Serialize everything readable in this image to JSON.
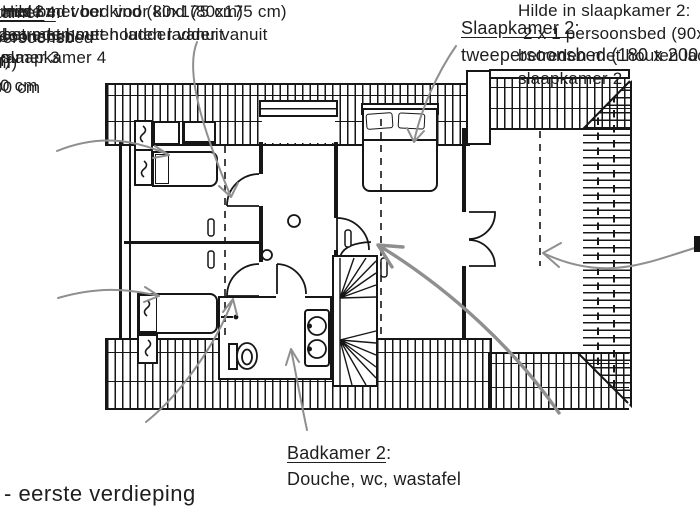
{
  "annotations": {
    "top_left": {
      "lines": [
        "met bed voor kind (80x175 cm)",
        "den met houten ladder vanuit",
        "kamer 3"
      ]
    },
    "top_right": {
      "title": "Slaapkamer 2",
      "colon": ":",
      "line": "tweepersoonsbed (180 x 200 cm)"
    },
    "mid_left": {
      "title": "mer 3",
      "colon": ":",
      "lines": [
        "soonsbed",
        "f)",
        "0 cm"
      ]
    },
    "lower_left": {
      "title": "kamer 4",
      "colon": ":",
      "lines": [
        "persoonsbed",
        "uif)",
        "00 cm"
      ]
    },
    "bottom_left": {
      "lines": [
        "Hilde met bed voor kind (80x175 cm)",
        "betreden met houten ladder vanuit",
        "slaapkamer 4"
      ]
    },
    "floor_caption": "- eerste verdieping",
    "bottom_center": {
      "title": "Badkamer 2",
      "colon": ":",
      "line": "Douche, wc, wastafel"
    },
    "bottom_right": {
      "lines": [
        "Hilde in slaapkamer 2:",
        "2 x 1 persoonsbed (90x190 cm)",
        "betreden met houten ladder",
        "slaapkamer 2"
      ]
    }
  },
  "colors": {
    "ink": "#1e1e1e",
    "leader_gray": "#8f8f8f",
    "background": "#ffffff"
  }
}
